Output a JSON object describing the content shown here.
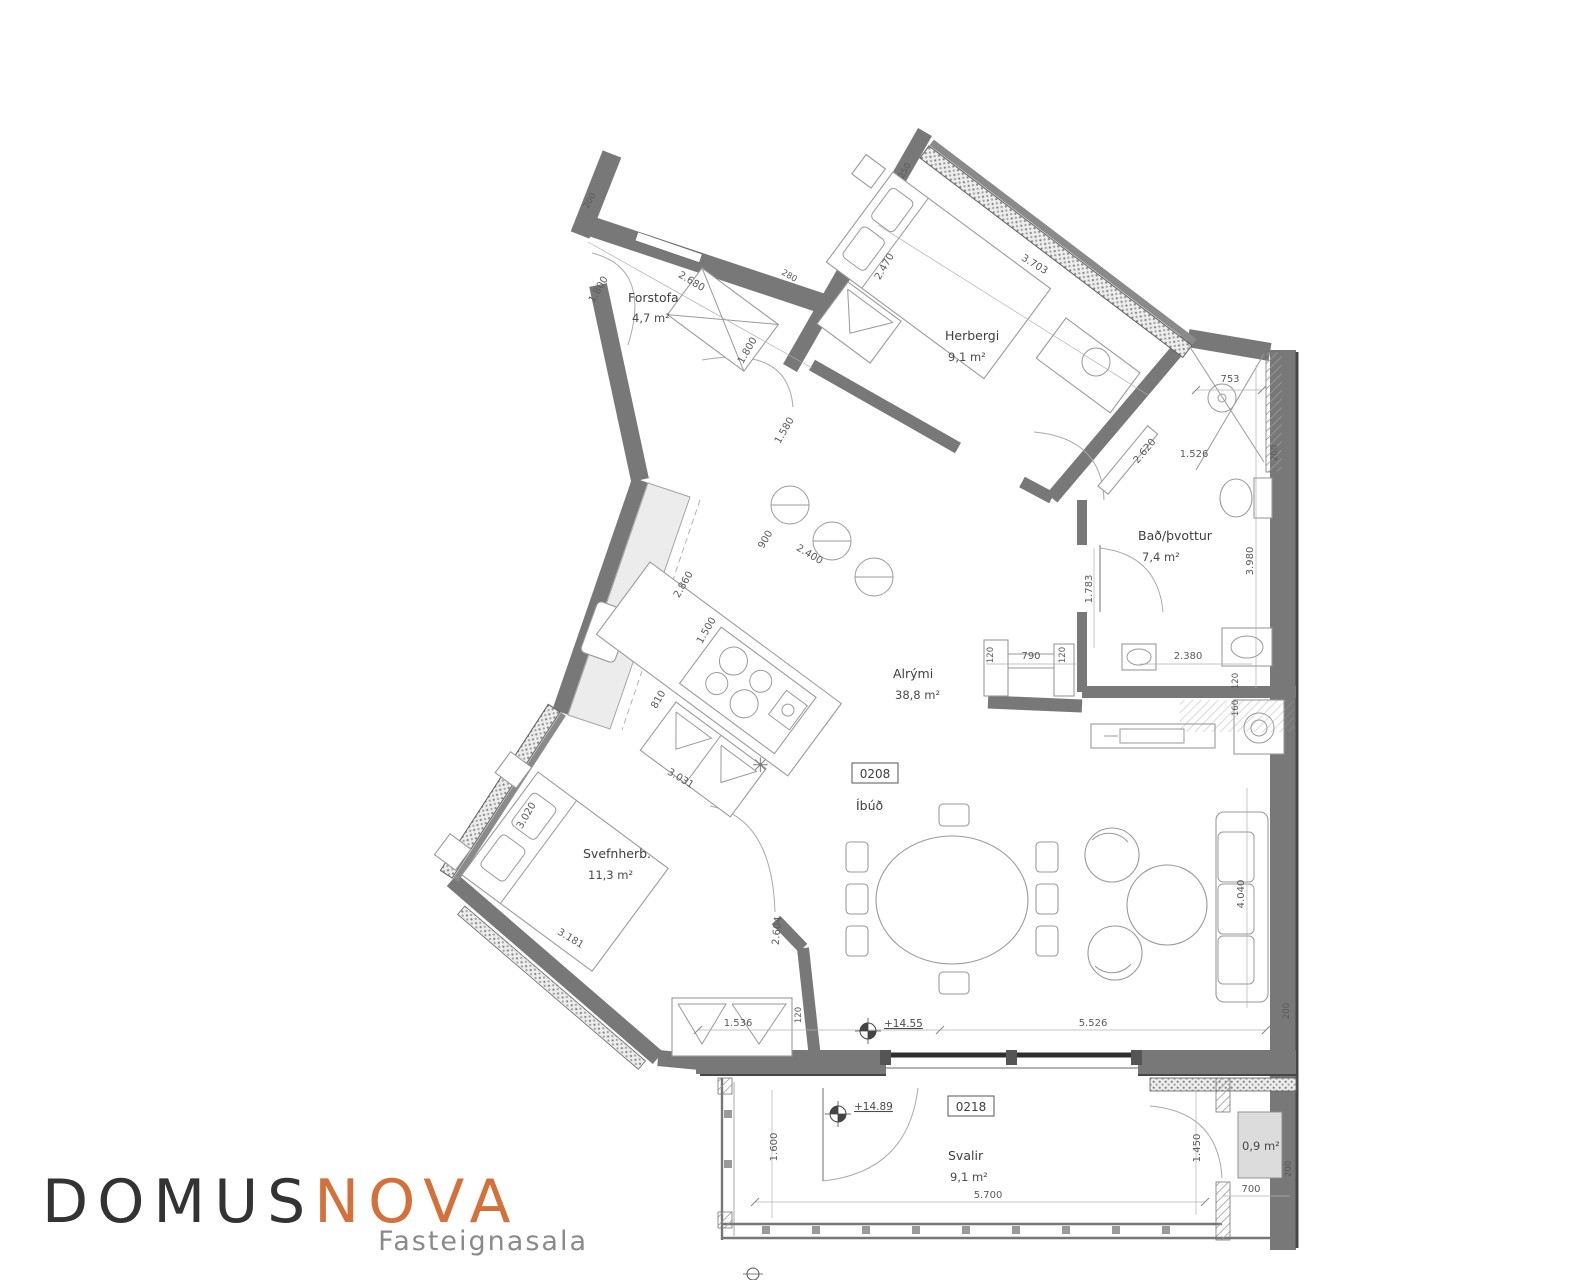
{
  "logo": {
    "brand_primary": "DOMUS",
    "brand_secondary": "NOVA",
    "tagline": "Fasteignasala",
    "accent_color": "#d4703a",
    "primary_color": "#333333"
  },
  "apartment": {
    "id": "0208",
    "type_label": "Íbúð",
    "balcony_id": "0218",
    "level_main": "+14.55",
    "level_balcony": "+14.89"
  },
  "rooms": {
    "forstofa": {
      "name": "Forstofa",
      "area": "4,7 m²"
    },
    "herbergi": {
      "name": "Herbergi",
      "area": "9,1 m²"
    },
    "bad": {
      "name": "Bað/þvottur",
      "area": "7,4 m²"
    },
    "alrymi": {
      "name": "Alrými",
      "area": "38,8 m²"
    },
    "svefnherb": {
      "name": "Svefnherb.",
      "area": "11,3 m²"
    },
    "svalir": {
      "name": "Svalir",
      "area": "9,1 m²"
    },
    "geymsla": {
      "area": "0,9 m²"
    }
  },
  "dims": {
    "d1800a": "1.800",
    "d2680": "2.680",
    "d200a": "200",
    "d280": "280",
    "d250": "250",
    "d1800b": "1.800",
    "d1580": "1.580",
    "d2470": "2.470",
    "d3703": "3.703",
    "d900": "900",
    "d2400": "2.400",
    "d2860": "2.860",
    "d1500": "1.500",
    "d810": "810",
    "d3020": "3.020",
    "d3031": "3.031",
    "d3181": "3.181",
    "d2604": "2.604",
    "d753": "753",
    "d2620": "2.620",
    "d1526": "1.526",
    "d200b": "200",
    "d3980": "3.980",
    "d1783": "1.783",
    "d120a": "120",
    "d790": "790",
    "d120b": "120",
    "d2380": "2.380",
    "d120c": "120",
    "d160": "160",
    "d4040": "4.040",
    "d1536": "1.536",
    "d120d": "120",
    "d5526": "5.526",
    "d200c": "200",
    "d1600": "1.600",
    "d5700": "5.700",
    "d1450": "1.450",
    "d700": "700",
    "d200d": "200"
  }
}
